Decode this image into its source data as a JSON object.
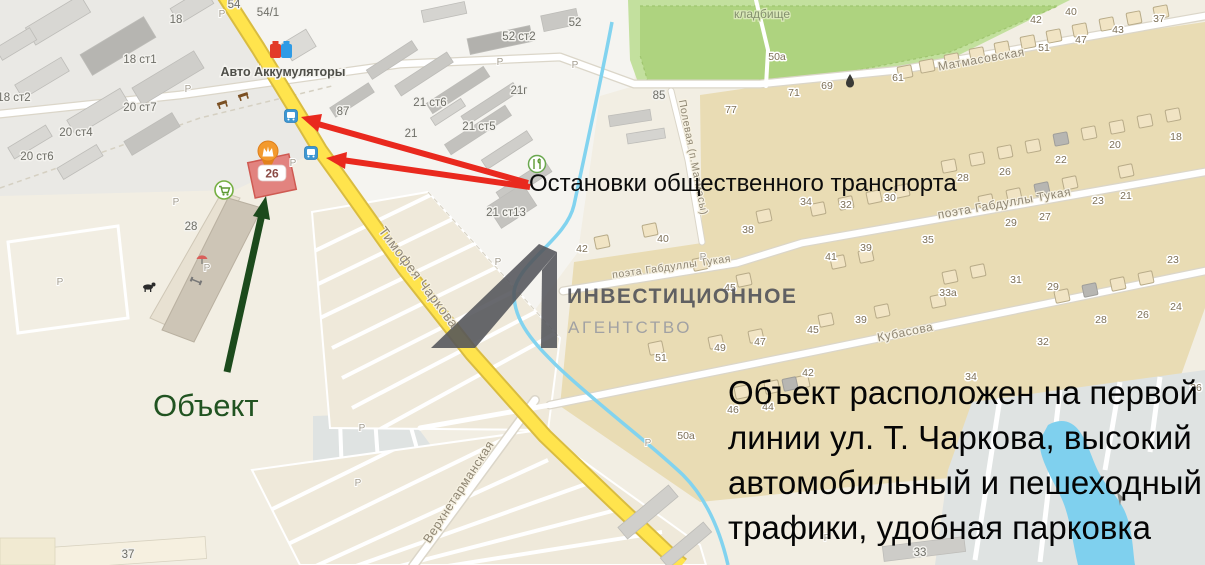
{
  "annotations": {
    "object_label": "Объект",
    "stops_label": "Остановки общественного транспорта",
    "description_lines": [
      "Объект расположен на первой",
      "линии ул. Т. Чаркова, высокий",
      "автомобильный и пешеходный",
      "трафики, удобная парковка"
    ],
    "colors": {
      "red_arrow": "#e9291e",
      "green_arrow": "#1c4a1c",
      "object_label_green": "#215321"
    }
  },
  "logo": {
    "line1": "ИНВЕСТИЦИОННОЕ",
    "line2": "АГЕНТСТВО",
    "color_dark": "#55565c",
    "color_light": "#9b9da2"
  },
  "map": {
    "object_building_number": "26",
    "parking_label": "P",
    "areas": {
      "cemetery": "кладбище"
    },
    "poi": {
      "battery_shop": "Авто Аккумуляторы"
    },
    "streets": [
      "Тимофея Чаркова",
      "Матмасовская",
      "поэта Габдуллы Тукая",
      "поэта Габдуллы Тукая",
      "Кубасова",
      "Полевая (п.Матмасы)",
      "Верхнетарманская"
    ],
    "labels": [
      "54",
      "54/1",
      "18",
      "18 ст1",
      "18 ст2",
      "20 ст7",
      "20 ст4",
      "20 ст6",
      "52",
      "52 ст2",
      "21г",
      "21 ст6",
      "21 ст5",
      "21",
      "21 ст13",
      "87",
      "85",
      "50a",
      "28",
      "37",
      "33",
      "50a",
      "69",
      "61",
      "51",
      "47",
      "43",
      "42",
      "40",
      "37",
      "77",
      "71",
      "28",
      "26",
      "22",
      "20",
      "18",
      "30",
      "32",
      "34",
      "29",
      "27",
      "23",
      "21",
      "35",
      "39",
      "41",
      "31",
      "33a",
      "29",
      "23",
      "39",
      "45",
      "28",
      "26",
      "24",
      "32",
      "42",
      "34",
      "46",
      "44",
      "45",
      "49",
      "47",
      "51",
      "40",
      "42",
      "38",
      "36"
    ],
    "icons": {
      "bus_stop": "bus-icon",
      "battery_shop": "battery-icon",
      "object_pin": "crown-pin-icon",
      "supermarket": "cart-icon",
      "cafe": "utensils-icon",
      "bench": "bench-icon",
      "dog_park": "dog-icon",
      "playground": "playground-icon",
      "gym": "dumbbell-icon",
      "spring": "droplet-icon"
    },
    "colors": {
      "road_yellow": "#ffe44d",
      "water": "#7fd0ee",
      "cemetery": "#b9db8e",
      "residential": "#e9dcb4",
      "object_building": "#e2837f"
    }
  }
}
